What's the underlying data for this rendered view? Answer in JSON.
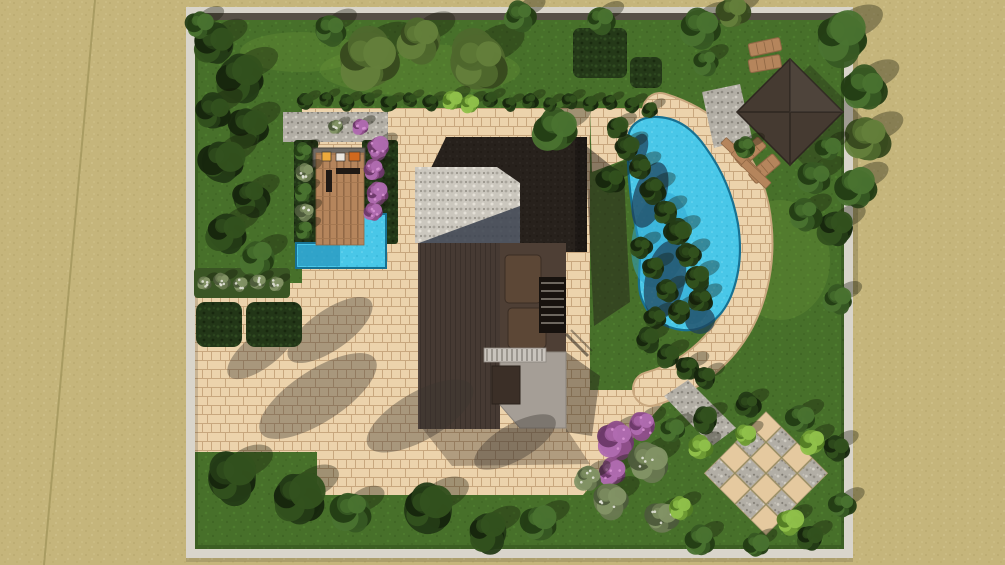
{
  "scene": {
    "width": 1005,
    "height": 565,
    "palette": {
      "sand": "#c5b57b",
      "sandDot1": "#b9a96d",
      "sandDot2": "#d0c18b",
      "sandLine": "#a3965c",
      "lawn": "#47702a",
      "lawnDot1": "#3d6322",
      "lawnDot2": "#518330",
      "lawnLight": "#6f9a3a",
      "paver": "#ecd3ac",
      "paverJoint": "#c8a77e",
      "wallLight": "#d9d5cb",
      "wallDark": "#564f46",
      "water": "#49c7e8",
      "waterLight": "#73d9f2",
      "waterDark": "#35b2d6",
      "waterShadow": "#1f4058",
      "waterMid": "#2fa6cf",
      "waterEdge": "#177192",
      "gravel": "#b2aea5",
      "gravelLight": "#cbc7be",
      "wood": "#b5855c",
      "woodDark": "#8f6744",
      "roofDark": "#27211c",
      "siding": "#463a33",
      "sidingLine": "#3a302a",
      "terrace": "#4e3f35",
      "furn": "#5c4736",
      "concrete": "#a59e96",
      "pergola": "#c9c4bd",
      "pergolaSlat": "#7d7770",
      "counter": "#6e6a64",
      "sofa": "#201914",
      "gazebo": "#453a31",
      "gazeboLine": "#332b24",
      "hedge": "#223617",
      "shadow": "#3a3430",
      "houseShadow": "#241e18",
      "roofTriShadow": "#3c4350",
      "checkerBeige": "#e5c99f",
      "itemYellow": "#edaa3c",
      "itemWhite": "#ece7df",
      "itemOrange": "#d2691e"
    },
    "treeTypes": {
      "dark": {
        "base": "#243b16",
        "dark": "#16250d",
        "light": "#33511e"
      },
      "mid": {
        "base": "#375923",
        "dark": "#233c14",
        "light": "#4a7330"
      },
      "olive": {
        "base": "#4f682d",
        "dark": "#37491e",
        "light": "#64803b"
      },
      "sage": {
        "base": "#697950",
        "dark": "#4c5a3a",
        "light": "#839465",
        "dots": "#e8e8de"
      },
      "light": {
        "base": "#6f9c35",
        "dark": "#527b24",
        "light": "#90c14b"
      },
      "purple": {
        "base": "#8f4f8a",
        "dark": "#6b3868",
        "light": "#b06bb0",
        "dots": "#d894d4"
      }
    },
    "sandDiagonal": [
      [
        95,
        0
      ],
      [
        44,
        565
      ]
    ],
    "wall": {
      "x": 186,
      "y": 7,
      "w": 667,
      "h": 551,
      "t": 9
    },
    "lawnRect": [
      194,
      14,
      651,
      535
    ],
    "lawnPatches": [
      [
        420,
        70,
        100,
        26
      ],
      [
        300,
        52,
        60,
        20
      ],
      [
        780,
        260,
        50,
        60
      ]
    ],
    "patioPolys": [
      [
        [
          194,
          283
        ],
        [
          302,
          283
        ],
        [
          302,
          108
        ],
        [
          590,
          108
        ],
        [
          590,
          452
        ],
        [
          194,
          452
        ]
      ],
      [
        [
          317,
          452
        ],
        [
          583,
          452
        ],
        [
          583,
          495
        ],
        [
          317,
          495
        ]
      ],
      [
        [
          583,
          495
        ],
        [
          675,
          390
        ],
        [
          590,
          390
        ],
        [
          583,
          410
        ]
      ],
      [
        [
          520,
          108
        ],
        [
          658,
          108
        ],
        [
          650,
          150
        ],
        [
          592,
          172
        ],
        [
          590,
          108
        ]
      ]
    ],
    "poolBand": {
      "d": "M660,110 C712,126 742,162 752,208 C762,260 750,312 718,347 C697,370 672,383 650,389",
      "width": 32
    },
    "connector": [
      [
        664,
        396
      ],
      [
        688,
        380
      ],
      [
        736,
        428
      ],
      [
        712,
        446
      ]
    ],
    "checkerboard": {
      "cx": 766,
      "cy": 474,
      "size": 22,
      "cols": 4,
      "rows": 4,
      "rotate": 45
    },
    "gravelStrip": [
      283,
      112,
      105,
      30
    ],
    "gazeboPad": [
      [
        702,
        92
      ],
      [
        740,
        84
      ],
      [
        752,
        138
      ],
      [
        714,
        148
      ]
    ],
    "deck": {
      "bedLeft": [
        294,
        140,
        24,
        104
      ],
      "bedRight": [
        362,
        140,
        36,
        104
      ],
      "counter": [
        313,
        148,
        52,
        19
      ],
      "deckRect": [
        316,
        153,
        48,
        92
      ],
      "items": [
        [
          322,
          152,
          9,
          9,
          "itemYellow"
        ],
        [
          336,
          153,
          9,
          8,
          "itemWhite"
        ],
        [
          349,
          152,
          11,
          9,
          "itemOrange"
        ]
      ],
      "sofa": [
        [
          336,
          168,
          24,
          6
        ],
        [
          326,
          170,
          6,
          22
        ]
      ]
    },
    "smallPool": {
      "pts": [
        [
          296,
          243
        ],
        [
          360,
          243
        ],
        [
          360,
          214
        ],
        [
          386,
          214
        ],
        [
          386,
          268
        ],
        [
          296,
          268
        ]
      ],
      "shadow": [
        298,
        245,
        42,
        21
      ]
    },
    "pool": {
      "d": "M628,140 C628,124 642,116 658,117 C678,118 694,130 706,148 C722,170 733,196 738,224 C742,250 740,274 731,296 C721,320 703,332 682,330 C664,328 650,318 643,302 C636,287 640,272 640,256 C640,240 634,224 632,206 C629,184 627,160 628,140 Z",
      "darkShadows": [
        [
          650,
          195,
          16,
          34,
          18
        ],
        [
          665,
          280,
          20,
          40,
          12
        ],
        [
          700,
          320,
          15,
          14,
          0
        ],
        [
          638,
          150,
          9,
          17,
          20
        ]
      ],
      "midShadows": [
        [
          660,
          240,
          28,
          48,
          10
        ],
        [
          692,
          300,
          18,
          24,
          0
        ]
      ]
    },
    "house": {
      "castShadows": [
        {
          "pts": [
            [
              585,
              145
            ],
            [
              624,
              176
            ],
            [
              630,
              302
            ],
            [
              594,
              326
            ]
          ],
          "op": 0.5
        },
        {
          "pts": [
            [
              566,
              352
            ],
            [
              600,
              376
            ],
            [
              592,
              436
            ],
            [
              566,
              432
            ]
          ],
          "op": 0.42
        },
        {
          "pts": [
            [
              422,
              428
            ],
            [
              566,
              428
            ],
            [
              590,
              464
            ],
            [
              452,
              466
            ]
          ],
          "op": 0.3
        }
      ],
      "roofTop": [
        [
          431,
          168
        ],
        [
          446,
          137
        ],
        [
          520,
          137
        ],
        [
          520,
          168
        ]
      ],
      "roofRight": [
        515,
        137,
        72,
        115
      ],
      "roofRightEdge": [
        575,
        137,
        12,
        115
      ],
      "gravelRoof": [
        415,
        167,
        105,
        76
      ],
      "notch": [
        [
          497,
          167
        ],
        [
          520,
          167
        ],
        [
          520,
          183
        ]
      ],
      "roofShadowTri": [
        [
          419,
          243
        ],
        [
          520,
          206
        ],
        [
          520,
          243
        ]
      ],
      "wingLeft": [
        418,
        243,
        82,
        186
      ],
      "terrace": [
        500,
        243,
        66,
        109
      ],
      "furniture": [
        [
          505,
          255,
          36,
          48
        ],
        [
          508,
          308,
          38,
          40
        ]
      ],
      "stairs": {
        "rect": [
          539,
          277,
          27,
          56
        ],
        "rungY0": 283,
        "rungStep": 8,
        "rungN": 6
      },
      "concrete": [
        [
          500,
          352
        ],
        [
          566,
          352
        ],
        [
          566,
          428
        ],
        [
          520,
          428
        ],
        [
          500,
          405
        ]
      ],
      "darkBox": [
        492,
        366,
        28,
        38
      ],
      "pergola": [
        484,
        348,
        62,
        14
      ]
    },
    "gazebo": {
      "cx": 790,
      "cy": 112,
      "size": 75,
      "rot": 45,
      "shadow": [
        [
          810,
          65
        ],
        [
          863,
          118
        ],
        [
          810,
          171
        ],
        [
          757,
          118
        ]
      ]
    },
    "hedges": [
      [
        196,
        302,
        46,
        45
      ],
      [
        246,
        302,
        56,
        45
      ]
    ],
    "grassBed": [
      194,
      268,
      96,
      30
    ],
    "squareHedges": [
      [
        573,
        28,
        54,
        50
      ],
      [
        630,
        57,
        32,
        31
      ]
    ],
    "loungers": [
      [
        748,
        44,
        -12
      ],
      [
        748,
        60,
        -10
      ],
      [
        734,
        158,
        -42
      ],
      [
        748,
        174,
        -40
      ]
    ],
    "steps": [
      [
        736,
        152
      ],
      [
        746,
        163
      ],
      [
        756,
        174
      ]
    ],
    "patioShadows": [
      [
        318,
        396,
        68,
        26,
        -33
      ],
      [
        420,
        416,
        60,
        24,
        -30
      ],
      [
        262,
        350,
        42,
        17,
        -38
      ],
      [
        515,
        442,
        46,
        18,
        -30
      ],
      [
        330,
        330,
        50,
        20,
        -35
      ]
    ],
    "trees": [
      [
        215,
        45,
        20,
        "dark"
      ],
      [
        240,
        78,
        24,
        "dark"
      ],
      [
        213,
        112,
        18,
        "dark"
      ],
      [
        248,
        128,
        20,
        "dark"
      ],
      [
        222,
        162,
        22,
        "dark"
      ],
      [
        250,
        198,
        18,
        "dark"
      ],
      [
        227,
        232,
        20,
        "dark"
      ],
      [
        258,
        258,
        18,
        "mid"
      ],
      [
        200,
        25,
        14,
        "mid"
      ],
      [
        330,
        30,
        16,
        "mid"
      ],
      [
        368,
        60,
        30,
        "olive"
      ],
      [
        420,
        40,
        22,
        "olive"
      ],
      [
        478,
        62,
        30,
        "olive"
      ],
      [
        520,
        16,
        15,
        "mid"
      ],
      [
        556,
        130,
        22,
        "mid"
      ],
      [
        600,
        20,
        14,
        "mid"
      ],
      [
        700,
        28,
        20,
        "mid"
      ],
      [
        733,
        12,
        16,
        "olive"
      ],
      [
        706,
        62,
        13,
        "mid"
      ],
      [
        842,
        38,
        26,
        "mid"
      ],
      [
        864,
        88,
        22,
        "mid"
      ],
      [
        868,
        140,
        22,
        "olive"
      ],
      [
        856,
        188,
        20,
        "mid"
      ],
      [
        836,
        228,
        18,
        "dark"
      ],
      [
        815,
        178,
        17,
        "mid"
      ],
      [
        805,
        215,
        16,
        "mid"
      ],
      [
        838,
        300,
        14,
        "mid"
      ],
      [
        745,
        148,
        11,
        "mid"
      ],
      [
        828,
        148,
        12,
        "mid"
      ],
      [
        627,
        148,
        12,
        "dark"
      ],
      [
        640,
        168,
        12,
        "dark"
      ],
      [
        653,
        190,
        13,
        "dark"
      ],
      [
        666,
        212,
        12,
        "dark"
      ],
      [
        678,
        233,
        13,
        "dark"
      ],
      [
        689,
        255,
        12,
        "dark"
      ],
      [
        697,
        278,
        13,
        "dark"
      ],
      [
        701,
        300,
        12,
        "dark"
      ],
      [
        641,
        247,
        11,
        "dark"
      ],
      [
        654,
        268,
        11,
        "dark"
      ],
      [
        667,
        291,
        11,
        "dark"
      ],
      [
        679,
        312,
        12,
        "dark"
      ],
      [
        655,
        318,
        11,
        "dark"
      ],
      [
        648,
        340,
        12,
        "dark"
      ],
      [
        668,
        356,
        12,
        "dark"
      ],
      [
        688,
        368,
        12,
        "dark"
      ],
      [
        705,
        378,
        11,
        "dark"
      ],
      [
        617,
        128,
        11,
        "dark"
      ],
      [
        610,
        180,
        14,
        "dark"
      ],
      [
        616,
        440,
        19,
        "purple"
      ],
      [
        642,
        425,
        14,
        "purple"
      ],
      [
        612,
        472,
        13,
        "purple"
      ],
      [
        648,
        462,
        20,
        "sage"
      ],
      [
        610,
        500,
        18,
        "sage"
      ],
      [
        662,
        518,
        16,
        "sage"
      ],
      [
        588,
        478,
        13,
        "sage"
      ],
      [
        705,
        420,
        13,
        "dark"
      ],
      [
        748,
        405,
        12,
        "dark"
      ],
      [
        800,
        418,
        14,
        "mid"
      ],
      [
        836,
        448,
        13,
        "dark"
      ],
      [
        842,
        505,
        13,
        "mid"
      ],
      [
        810,
        538,
        13,
        "dark"
      ],
      [
        756,
        545,
        12,
        "mid"
      ],
      [
        700,
        540,
        14,
        "mid"
      ],
      [
        672,
        430,
        12,
        "mid"
      ],
      [
        700,
        448,
        12,
        "light"
      ],
      [
        812,
        442,
        13,
        "light"
      ],
      [
        680,
        508,
        12,
        "light"
      ],
      [
        790,
        522,
        13,
        "light"
      ],
      [
        745,
        435,
        10,
        "light"
      ],
      [
        232,
        478,
        26,
        "dark"
      ],
      [
        298,
        498,
        26,
        "dark"
      ],
      [
        352,
        512,
        20,
        "mid"
      ],
      [
        428,
        510,
        26,
        "dark"
      ],
      [
        488,
        532,
        20,
        "dark"
      ],
      [
        540,
        524,
        18,
        "mid"
      ],
      [
        303,
        152,
        9,
        "mid"
      ],
      [
        305,
        172,
        9,
        "sage"
      ],
      [
        303,
        192,
        9,
        "mid"
      ],
      [
        305,
        212,
        9,
        "sage"
      ],
      [
        304,
        230,
        9,
        "mid"
      ],
      [
        378,
        148,
        11,
        "purple"
      ],
      [
        374,
        170,
        10,
        "purple"
      ],
      [
        377,
        193,
        11,
        "purple"
      ],
      [
        373,
        212,
        9,
        "purple"
      ],
      [
        204,
        283,
        7,
        "sage"
      ],
      [
        222,
        281,
        8,
        "sage"
      ],
      [
        240,
        284,
        7,
        "sage"
      ],
      [
        258,
        282,
        8,
        "sage"
      ],
      [
        276,
        284,
        7,
        "sage"
      ],
      [
        305,
        102,
        8,
        "dark"
      ],
      [
        326,
        99,
        7,
        "dark"
      ],
      [
        347,
        103,
        8,
        "dark"
      ],
      [
        368,
        100,
        7,
        "dark"
      ],
      [
        389,
        104,
        8,
        "dark"
      ],
      [
        410,
        100,
        7,
        "dark"
      ],
      [
        431,
        103,
        8,
        "dark"
      ],
      [
        452,
        100,
        10,
        "light"
      ],
      [
        470,
        104,
        9,
        "light"
      ],
      [
        490,
        100,
        8,
        "dark"
      ],
      [
        510,
        104,
        7,
        "dark"
      ],
      [
        530,
        101,
        8,
        "dark"
      ],
      [
        550,
        104,
        7,
        "dark"
      ],
      [
        570,
        101,
        8,
        "dark"
      ],
      [
        590,
        104,
        8,
        "dark"
      ],
      [
        610,
        102,
        7,
        "dark"
      ],
      [
        632,
        105,
        8,
        "dark"
      ],
      [
        650,
        110,
        8,
        "dark"
      ],
      [
        360,
        127,
        8,
        "purple"
      ],
      [
        336,
        127,
        7,
        "sage"
      ]
    ]
  }
}
